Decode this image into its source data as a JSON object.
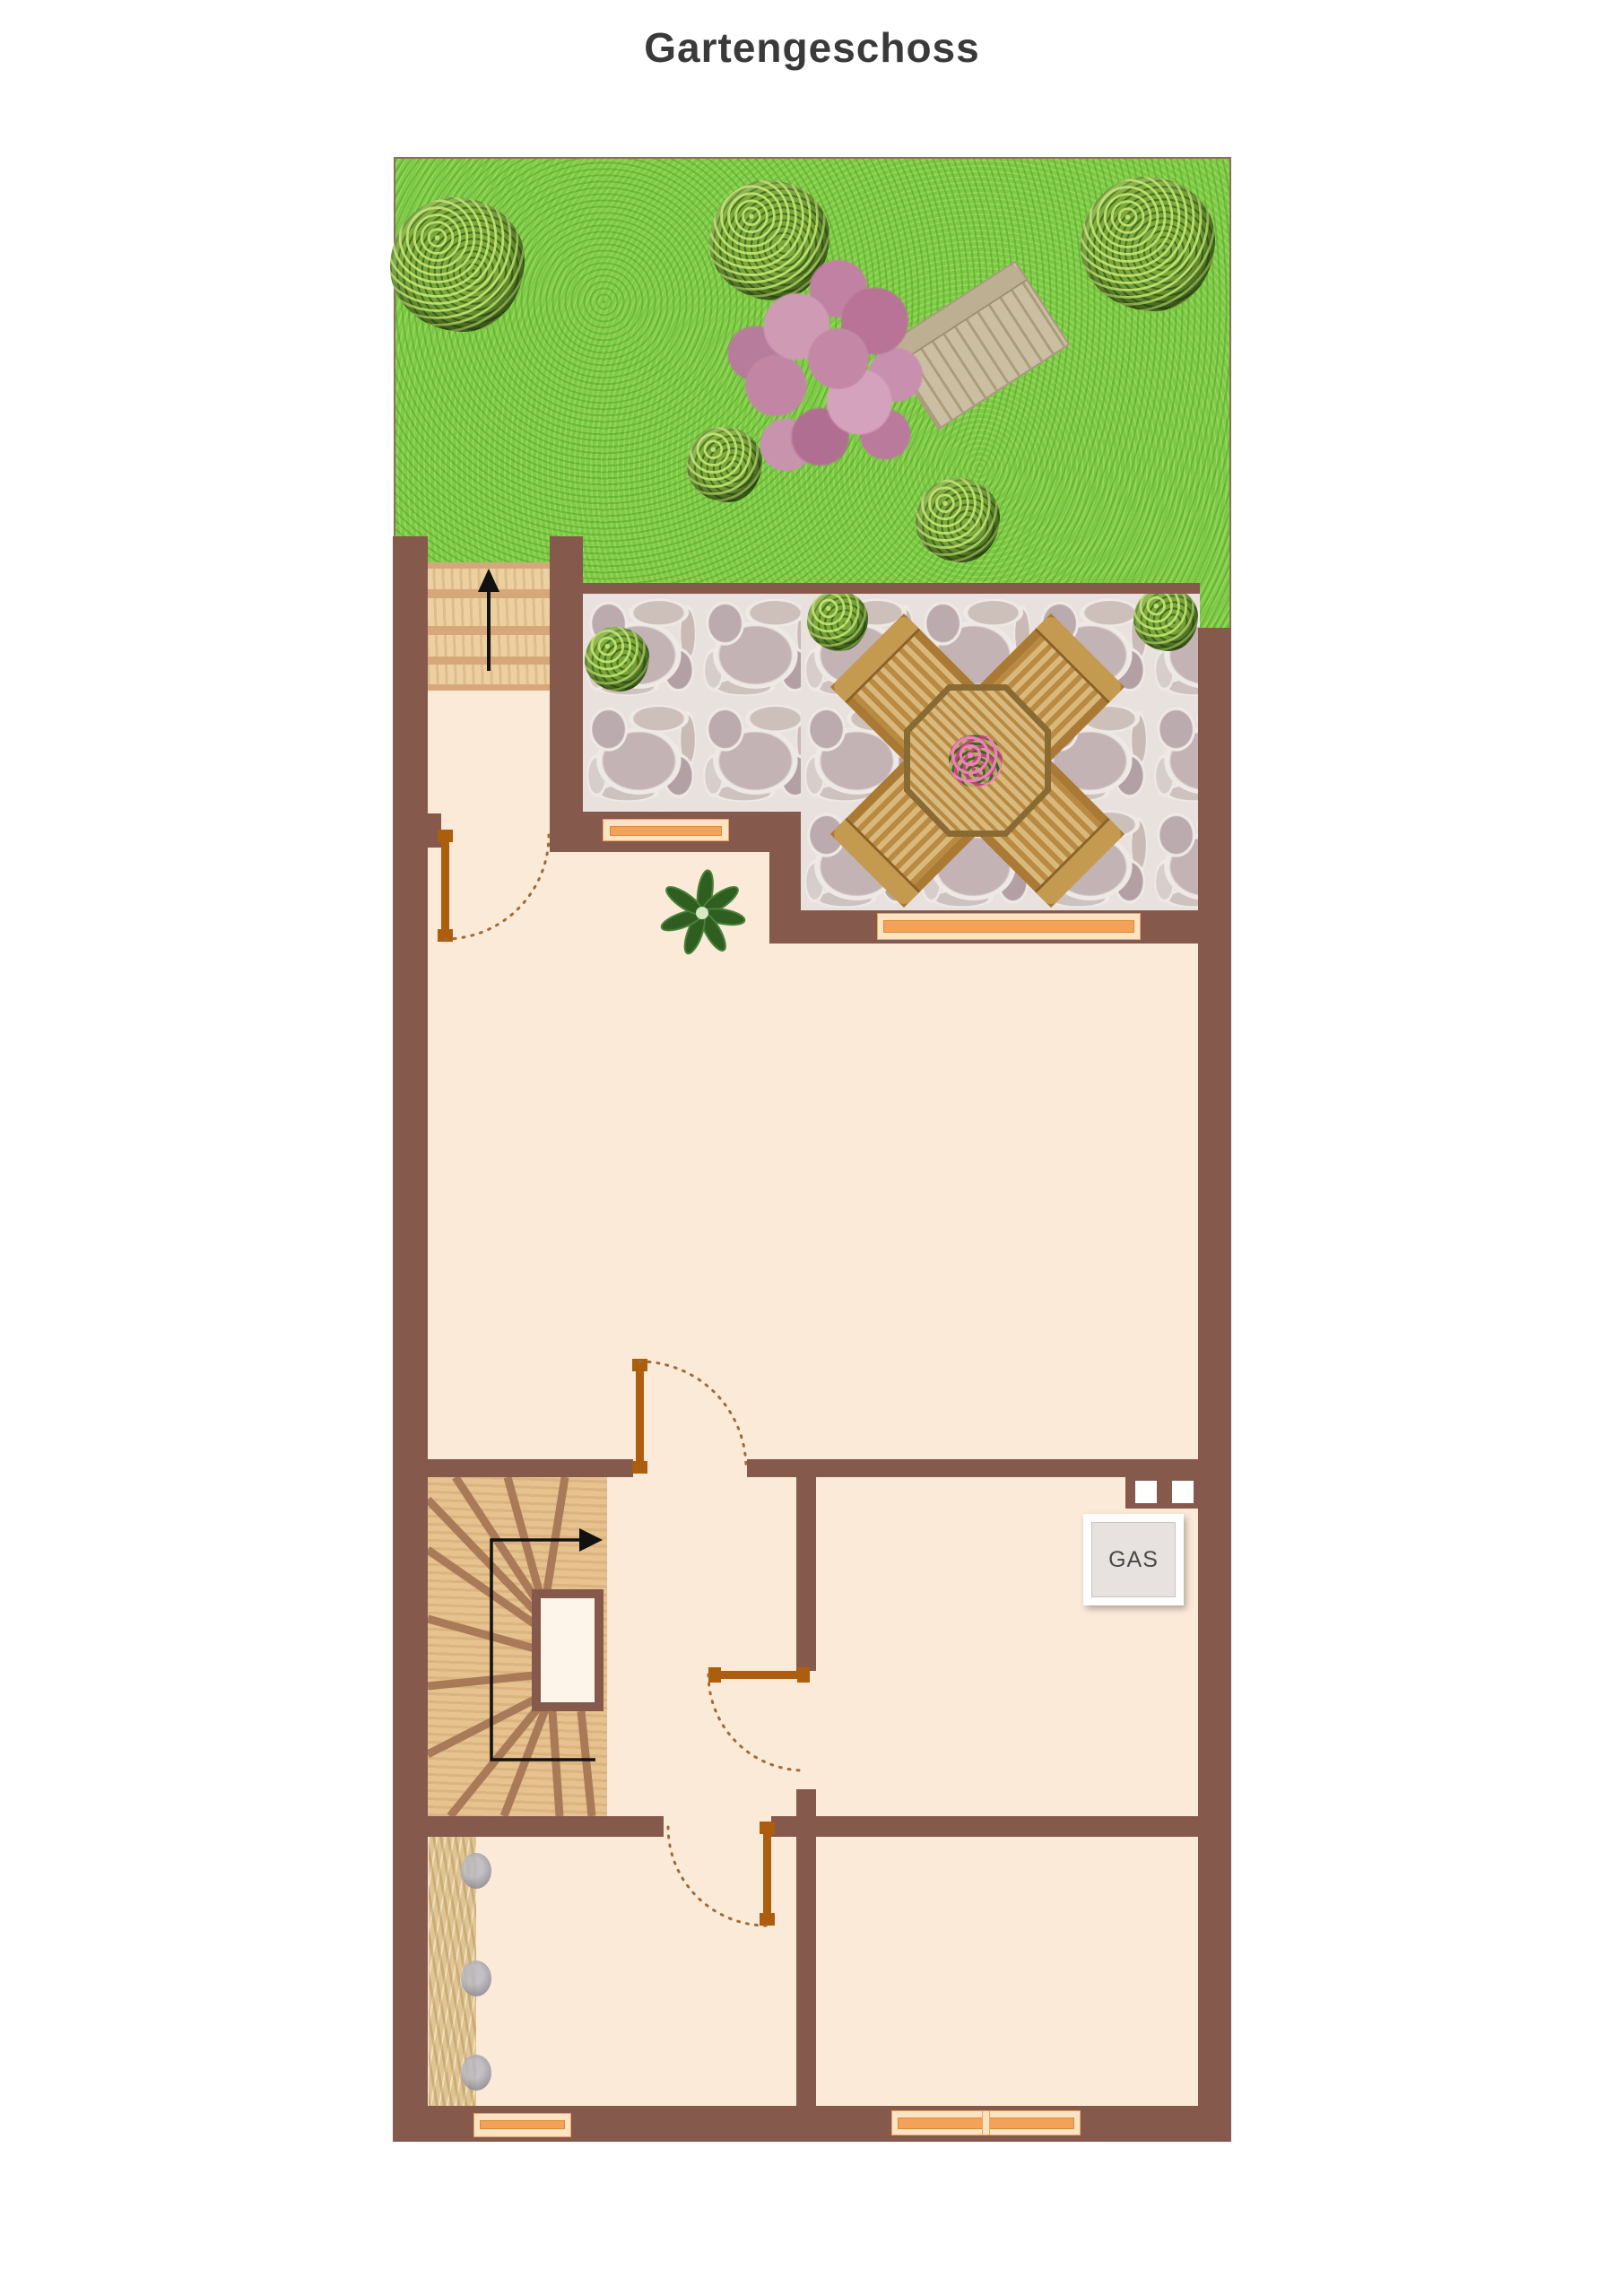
{
  "page": {
    "title": "Gartengeschoss"
  },
  "plan": {
    "gas_label": "GAS",
    "floor_name": "Gartengeschoss",
    "colors": {
      "wall": "#86594d",
      "floor": "#fcead8",
      "grass": "#7cc845",
      "stone_patio": "#cfc4c2",
      "window_accent": "#f4a258",
      "door_accent": "#ac5d0e",
      "stairs_wood": "#ecd0a2",
      "spiral_wood": "#e6c28f",
      "title_text": "#3a3a3a",
      "arrow": "#111111"
    },
    "outdoor": {
      "garden_bush_count": 5,
      "patio_bush_count": 3,
      "patio_furniture": "octagonal table with 4 chairs and flower centerpiece",
      "bench": "garden bench beside blossom tree"
    },
    "indoor": {
      "window_count": 4,
      "door_count": 4,
      "stairs": [
        {
          "name": "garden-stairs",
          "direction": "up"
        },
        {
          "name": "spiral-stairs",
          "direction": "up-right"
        }
      ],
      "fixtures": [
        "gas-meter",
        "closet",
        "potted-plant",
        "chimney-vents"
      ]
    }
  }
}
